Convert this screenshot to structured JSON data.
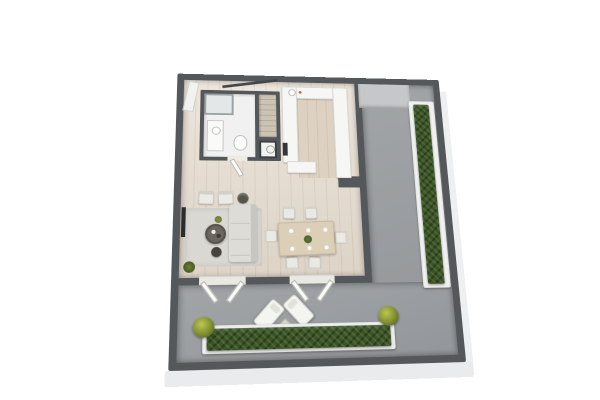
{
  "scene": {
    "type": "3d-floor-plan-render",
    "label": "Isometric 3D floor plan of an apartment with bathroom, staircase, U-shaped kitchen, open living-dining room and an L-shaped terrace lined with hedge planters",
    "background_color": "#ffffff"
  },
  "palette": {
    "wall_dark_gray": "#55585b",
    "wood_floor": "#e6dccf",
    "kitchen_floor": "#ddd1c1",
    "bathroom_floor": "#f0f1f0",
    "terrace_floor_gray": "#9b9ea1",
    "ledge_gray": "#c5c7c9",
    "hedge_green": "#3a5523",
    "bush_yellow_green": "#a3af42",
    "planter_white": "#f0f1f0",
    "counter_white": "#f6f6f4",
    "upholstery_gray": "#dedcd7",
    "dining_table_wood": "#dbd0b7",
    "floor_slab_white": "#e9ebec",
    "tv_dark": "#2a2c2e"
  },
  "rooms": [
    {
      "id": "apartment-interior",
      "label": "Apartment interior with light wood flooring"
    },
    {
      "id": "bathroom",
      "label": "Bathroom with shower, vanity sink and toilet"
    },
    {
      "id": "kitchen",
      "label": "U-shaped kitchen with white counters and sink"
    },
    {
      "id": "living-area",
      "label": "Living area with corner sofa, two armchairs, coffee table, rug and wall TV"
    },
    {
      "id": "dining-area",
      "label": "Dining area with table set for six"
    },
    {
      "id": "terrace",
      "label": "Terrace with two loungers, side table and hedge planters"
    },
    {
      "id": "terrace-side",
      "label": "Side terrace strip with hedge planter along the outer wall"
    }
  ],
  "furniture": {
    "bathroom": [
      "shower",
      "vanity-sink",
      "toilet",
      "washing-machine"
    ],
    "hall": [
      "staircase",
      "stair-railing",
      "entry-door",
      "bathroom-door"
    ],
    "kitchen": [
      "top-counter",
      "left-counter",
      "right-counter",
      "peninsula",
      "sink",
      "faucet",
      "oven"
    ],
    "living": [
      "corner-sofa",
      "armchair-left",
      "armchair-right",
      "coffee-table",
      "side-table",
      "basket",
      "rug",
      "tv",
      "plant",
      "corner-plant"
    ],
    "dining": [
      "dining-table",
      "six-chairs",
      "six-plates",
      "green-centerpiece"
    ],
    "terrace": [
      "french-door-left",
      "french-door-right",
      "lounger-left",
      "lounger-right",
      "side-table",
      "bottom-hedge-planter",
      "right-hedge-planter",
      "bush-left",
      "bush-right"
    ]
  },
  "counts": {
    "dining_chairs": 6,
    "plates_on_table": 6,
    "lounge_chairs": 2,
    "armchairs": 2,
    "terrace_door_openings": 2,
    "hedge_planters": 2,
    "corner_bushes": 2
  }
}
